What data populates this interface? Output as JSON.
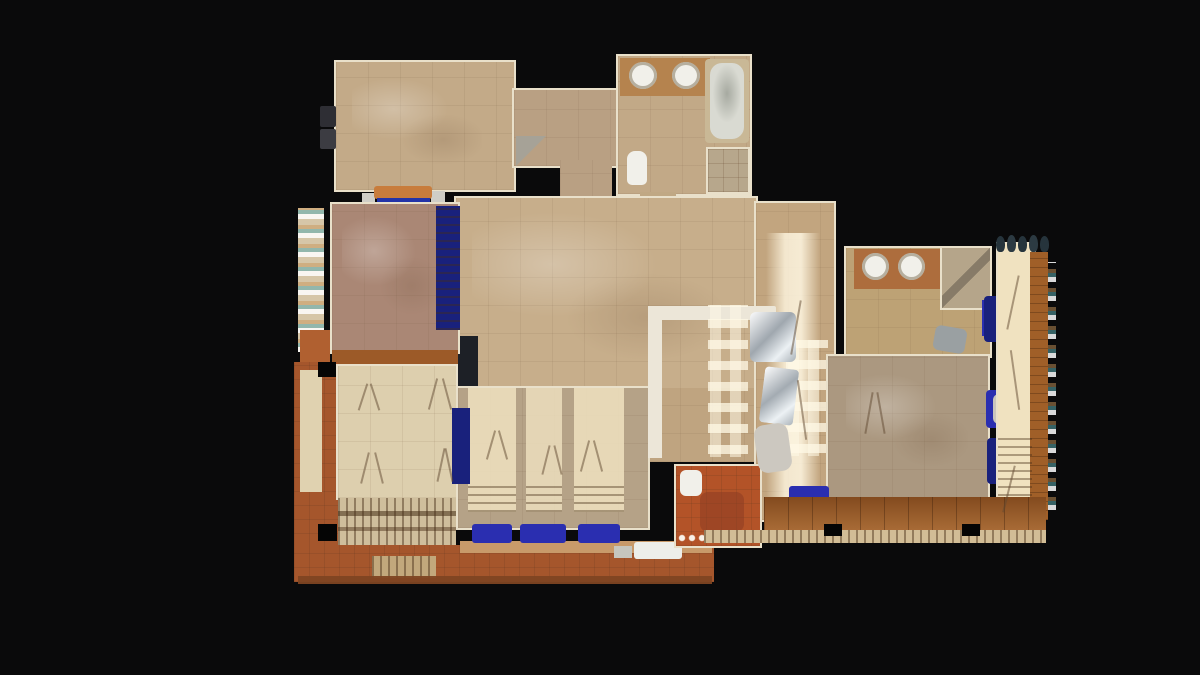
{
  "view": {
    "background": "#0a0a0b",
    "width": 1200,
    "height": 675
  },
  "palette": {
    "black": "#0a0a0b",
    "wall": "#e9e0ca",
    "tan1": "#c3aa88",
    "tan2": "#b9a083",
    "tan3": "#c7ae8b",
    "tan4": "#b5a287",
    "tan5": "#bda275",
    "tan6": "#ab9880",
    "cream": "#ddcfae",
    "cream2": "#f0e2c0",
    "mauve": "#aa8775",
    "terra": "#a5562c",
    "terra2": "#b35328",
    "rust": "#9c5a28",
    "wood": "#9a5824",
    "wood2": "#a05f28",
    "counter1": "#b5834e",
    "counter2": "#ad6d3d",
    "white": "#f1f0ea",
    "gray": "#9aa0a2",
    "navy": "#19217c",
    "blue": "#2a2eb0",
    "steel": "#c3c8cc",
    "sh": "rgba(95,72,48,0.5)"
  },
  "scene": {
    "items": [
      {
        "n": "master-bedroom-floor",
        "x": 336,
        "y": 62,
        "w": 178,
        "h": 128,
        "f": "tan1",
        "t": "tile",
        "wall": true
      },
      {
        "n": "master-bedroom-floor-sheen",
        "x": 352,
        "y": 78,
        "w": 130,
        "h": 88,
        "f": "none",
        "t": "mottle"
      },
      {
        "n": "wall-ac-unit-1",
        "x": 320,
        "y": 106,
        "w": 16,
        "h": 21,
        "f": "#2e2e34",
        "r": "2px"
      },
      {
        "n": "wall-ac-unit-2",
        "x": 320,
        "y": 129,
        "w": 16,
        "h": 20,
        "f": "#3c3c42",
        "r": "2px"
      },
      {
        "n": "bench-gray-left",
        "x": 362,
        "y": 193,
        "w": 13,
        "h": 15,
        "f": "#cfcdc6"
      },
      {
        "n": "bench-gray-right",
        "x": 431,
        "y": 191,
        "w": 14,
        "h": 17,
        "f": "#cfcdc6"
      },
      {
        "n": "daybed-orange",
        "x": 374,
        "y": 186,
        "w": 58,
        "h": 13,
        "f": "#c87c3c",
        "r": "3px"
      },
      {
        "n": "daybed-blue-cushion",
        "x": 377,
        "y": 198,
        "w": 53,
        "h": 10,
        "f": "#2333a8"
      },
      {
        "n": "vestibule-floor",
        "x": 514,
        "y": 90,
        "w": 103,
        "h": 76,
        "f": "tan2",
        "t": "tile",
        "wall": true
      },
      {
        "n": "vestibule-door-swing",
        "x": 516,
        "y": 136,
        "w": 30,
        "h": 30,
        "f": "none",
        "t": "tri"
      },
      {
        "n": "hallway-connector",
        "x": 560,
        "y": 160,
        "w": 52,
        "h": 42,
        "f": "tan2",
        "t": "tile"
      },
      {
        "n": "bathroom1-floor",
        "x": 618,
        "y": 56,
        "w": 132,
        "h": 138,
        "f": "#c2a987",
        "t": "tile",
        "wall": true
      },
      {
        "n": "bathroom1-vanity-counter",
        "x": 620,
        "y": 58,
        "w": 90,
        "h": 38,
        "f": "counter1"
      },
      {
        "n": "bathroom1-sink-left",
        "x": 629,
        "y": 62,
        "w": 28,
        "h": 27,
        "f": "white",
        "shape": "ellipse",
        "ring": true
      },
      {
        "n": "bathroom1-sink-right",
        "x": 672,
        "y": 62,
        "w": 28,
        "h": 27,
        "f": "white",
        "shape": "ellipse",
        "ring": true
      },
      {
        "n": "bathtub-surround",
        "x": 705,
        "y": 59,
        "w": 44,
        "h": 84,
        "f": "#c9b896",
        "r": "4px"
      },
      {
        "n": "bathtub-basin",
        "x": 710,
        "y": 63,
        "w": 34,
        "h": 76,
        "f": "#d9dad2",
        "t": "tub",
        "r": "12px"
      },
      {
        "n": "shower1-enclosure",
        "x": 708,
        "y": 149,
        "w": 40,
        "h": 43,
        "f": "#b7a78c",
        "t": "tile-small",
        "wall": true
      },
      {
        "n": "toilet1",
        "x": 627,
        "y": 151,
        "w": 20,
        "h": 34,
        "f": "white",
        "r": "8px 8px 5px 5px"
      },
      {
        "n": "bathroom1-door-connector",
        "x": 640,
        "y": 192,
        "w": 36,
        "h": 10,
        "f": "#c0a884"
      },
      {
        "n": "living-room-floor",
        "x": 456,
        "y": 198,
        "w": 300,
        "h": 192,
        "f": "tan3",
        "t": "tile",
        "wall": true
      },
      {
        "n": "living-room-floor-sheen",
        "x": 472,
        "y": 212,
        "w": 250,
        "h": 150,
        "f": "none",
        "t": "mottle"
      },
      {
        "n": "kitchen-corridor-floor",
        "x": 648,
        "y": 388,
        "w": 108,
        "h": 74,
        "f": "#bfa480",
        "t": "tile"
      },
      {
        "n": "dining-corridor-floor",
        "x": 756,
        "y": 203,
        "w": 78,
        "h": 317,
        "f": "#c2a57f",
        "t": "tile",
        "wall": true
      },
      {
        "n": "sunlight-streak",
        "x": 766,
        "y": 233,
        "w": 54,
        "h": 278,
        "f": "none",
        "t": "streak"
      },
      {
        "n": "lower-living-floor",
        "x": 458,
        "y": 388,
        "w": 190,
        "h": 140,
        "f": "tan4",
        "t": "tile",
        "wall": true
      },
      {
        "n": "sunlight-band-1",
        "x": 468,
        "y": 388,
        "w": 48,
        "h": 124,
        "f": "cream2",
        "op": 0.85
      },
      {
        "n": "sunlight-band-2",
        "x": 526,
        "y": 388,
        "w": 36,
        "h": 124,
        "f": "cream2",
        "op": 0.8
      },
      {
        "n": "sunlight-band-3",
        "x": 574,
        "y": 388,
        "w": 50,
        "h": 124,
        "f": "cream2",
        "op": 0.85
      },
      {
        "n": "shutter-shadow-1",
        "x": 468,
        "y": 486,
        "w": 48,
        "h": 26,
        "f": "none",
        "t": "slats-h"
      },
      {
        "n": "shutter-shadow-2",
        "x": 526,
        "y": 486,
        "w": 36,
        "h": 26,
        "f": "none",
        "t": "slats-h"
      },
      {
        "n": "shutter-shadow-3",
        "x": 574,
        "y": 486,
        "w": 50,
        "h": 26,
        "f": "none",
        "t": "slats-h"
      },
      {
        "n": "kitchen-counter-top",
        "x": 648,
        "y": 306,
        "w": 128,
        "h": 14,
        "f": "#ece6d8",
        "r": "2px"
      },
      {
        "n": "kitchen-counter-side",
        "x": 648,
        "y": 306,
        "w": 14,
        "h": 152,
        "f": "#ece6d8"
      },
      {
        "n": "window-lattice-light-1",
        "x": 708,
        "y": 305,
        "w": 40,
        "h": 152,
        "f": "none",
        "t": "lattice"
      },
      {
        "n": "window-lattice-light-2",
        "x": 786,
        "y": 340,
        "w": 42,
        "h": 116,
        "f": "none",
        "t": "lattice"
      },
      {
        "n": "steel-appliance-1",
        "x": 750,
        "y": 312,
        "w": 46,
        "h": 50,
        "f": "steel",
        "t": "shine",
        "r": "6px"
      },
      {
        "n": "steel-appliance-2",
        "x": 762,
        "y": 368,
        "w": 34,
        "h": 56,
        "f": "#ccd1d4",
        "t": "shine",
        "r": "4px",
        "rot": 7
      },
      {
        "n": "fireplace-dark-object",
        "x": 452,
        "y": 336,
        "w": 26,
        "h": 50,
        "f": "#1d2026"
      },
      {
        "n": "pink-bedroom-floor",
        "x": 332,
        "y": 204,
        "w": 126,
        "h": 148,
        "f": "mauve",
        "t": "tile",
        "wall": true
      },
      {
        "n": "pink-bedroom-sheen",
        "x": 342,
        "y": 216,
        "w": 100,
        "h": 100,
        "f": "none",
        "t": "mottle"
      },
      {
        "n": "blue-drapery",
        "x": 436,
        "y": 206,
        "w": 24,
        "h": 124,
        "f": "navy",
        "t": "slats-h"
      },
      {
        "n": "balcony-left-railing",
        "x": 298,
        "y": 208,
        "w": 26,
        "h": 144,
        "f": "#d6c6a8",
        "t": "speckle"
      },
      {
        "n": "balcony-left-terracotta",
        "x": 300,
        "y": 330,
        "w": 30,
        "h": 44,
        "f": "#b06030"
      },
      {
        "n": "blue-chest",
        "x": 433,
        "y": 352,
        "w": 22,
        "h": 26,
        "f": "navy"
      },
      {
        "n": "rust-transition-band",
        "x": 332,
        "y": 350,
        "w": 126,
        "h": 14,
        "f": "rust"
      },
      {
        "n": "terrace-walkway-left",
        "x": 294,
        "y": 362,
        "w": 44,
        "h": 214,
        "f": "terra",
        "t": "tile-small"
      },
      {
        "n": "terrace-walkway-inner-cream",
        "x": 300,
        "y": 370,
        "w": 22,
        "h": 122,
        "f": "#e0d2b0"
      },
      {
        "n": "garden-room-floor",
        "x": 338,
        "y": 366,
        "w": 118,
        "h": 132,
        "f": "cream",
        "t": "tile",
        "wall": true
      },
      {
        "n": "pergola-slatted-deck",
        "x": 338,
        "y": 498,
        "w": 118,
        "h": 62,
        "f": "#cfbe9c",
        "t": "slats-v"
      },
      {
        "n": "pergola-beam-1",
        "x": 338,
        "y": 511,
        "w": 118,
        "h": 5,
        "f": "rgba(70,45,22,0.55)"
      },
      {
        "n": "pergola-beam-2",
        "x": 338,
        "y": 527,
        "w": 118,
        "h": 4,
        "f": "rgba(70,45,22,0.45)"
      },
      {
        "n": "corner-post-1",
        "x": 318,
        "y": 362,
        "w": 18,
        "h": 15,
        "f": "#050505"
      },
      {
        "n": "corner-post-2",
        "x": 318,
        "y": 524,
        "w": 19,
        "h": 17,
        "f": "#050505"
      },
      {
        "n": "blue-daybed",
        "x": 452,
        "y": 408,
        "w": 18,
        "h": 76,
        "f": "navy"
      },
      {
        "n": "terrace-floor",
        "x": 294,
        "y": 545,
        "w": 420,
        "h": 37,
        "f": "terra",
        "t": "tile-small"
      },
      {
        "n": "terrace-tan-band",
        "x": 460,
        "y": 541,
        "w": 252,
        "h": 12,
        "f": "#c89a6a"
      },
      {
        "n": "terrace-steps",
        "x": 372,
        "y": 556,
        "w": 64,
        "h": 22,
        "f": "#c2a87c",
        "t": "slats-v"
      },
      {
        "n": "sofa-lounger-1",
        "x": 472,
        "y": 524,
        "w": 40,
        "h": 19,
        "f": "blue",
        "r": "3px"
      },
      {
        "n": "sofa-lounger-2",
        "x": 520,
        "y": 524,
        "w": 46,
        "h": 19,
        "f": "blue",
        "r": "3px"
      },
      {
        "n": "sofa-lounger-3",
        "x": 578,
        "y": 524,
        "w": 42,
        "h": 19,
        "f": "blue",
        "r": "3px"
      },
      {
        "n": "terrace-table-white",
        "x": 634,
        "y": 542,
        "w": 48,
        "h": 17,
        "f": "#edeeea",
        "r": "3px"
      },
      {
        "n": "terrace-object-gray",
        "x": 614,
        "y": 546,
        "w": 18,
        "h": 12,
        "f": "#c6c6be"
      },
      {
        "n": "terrace-edge",
        "x": 298,
        "y": 576,
        "w": 414,
        "h": 8,
        "f": "#7e4522",
        "op": 0.95
      },
      {
        "n": "patio-room-floor",
        "x": 676,
        "y": 466,
        "w": 84,
        "h": 80,
        "f": "terra2",
        "t": "tile-small",
        "wall": true
      },
      {
        "n": "patio-red-patch",
        "x": 700,
        "y": 492,
        "w": 44,
        "h": 40,
        "f": "rgba(140,60,35,0.55)",
        "r": "8px"
      },
      {
        "n": "patio-toilet",
        "x": 680,
        "y": 470,
        "w": 22,
        "h": 26,
        "f": "white",
        "r": "6px"
      },
      {
        "n": "pebble-border",
        "x": 678,
        "y": 534,
        "w": 80,
        "h": 9,
        "f": "none",
        "t": "dots"
      },
      {
        "n": "patio-chair-gray",
        "x": 756,
        "y": 424,
        "w": 34,
        "h": 48,
        "f": "#ccc8c0",
        "r": "10px",
        "rot": -8
      },
      {
        "n": "bathroom2-floor",
        "x": 846,
        "y": 248,
        "w": 144,
        "h": 108,
        "f": "tan5",
        "t": "tile",
        "wall": true
      },
      {
        "n": "bathroom2-vanity-counter",
        "x": 854,
        "y": 249,
        "w": 86,
        "h": 40,
        "f": "counter2"
      },
      {
        "n": "bathroom2-sink-left",
        "x": 862,
        "y": 253,
        "w": 27,
        "h": 27,
        "f": "white",
        "shape": "ellipse",
        "ring": true
      },
      {
        "n": "bathroom2-sink-right",
        "x": 898,
        "y": 253,
        "w": 27,
        "h": 27,
        "f": "white",
        "shape": "ellipse",
        "ring": true
      },
      {
        "n": "shower2-enclosure",
        "x": 942,
        "y": 248,
        "w": 48,
        "h": 60,
        "f": "#b5a58a",
        "t": "diag",
        "wall": true
      },
      {
        "n": "towel-blue",
        "x": 982,
        "y": 300,
        "w": 13,
        "h": 36,
        "f": "blue"
      },
      {
        "n": "bathroom2-stool",
        "x": 934,
        "y": 327,
        "w": 32,
        "h": 25,
        "f": "gray",
        "r": "6px",
        "rot": 10
      },
      {
        "n": "bedroom2-floor",
        "x": 828,
        "y": 356,
        "w": 160,
        "h": 142,
        "f": "tan6",
        "t": "tile",
        "wall": true
      },
      {
        "n": "bedroom2-sheen",
        "x": 846,
        "y": 374,
        "w": 122,
        "h": 94,
        "f": "none",
        "t": "mottle"
      },
      {
        "n": "bedroom2-sofa-blue",
        "x": 789,
        "y": 486,
        "w": 40,
        "h": 18,
        "f": "blue",
        "r": "3px"
      },
      {
        "n": "planter-blue-1",
        "x": 984,
        "y": 296,
        "w": 22,
        "h": 46,
        "f": "navy",
        "r": "4px"
      },
      {
        "n": "planter-blue-2",
        "x": 986,
        "y": 390,
        "w": 20,
        "h": 38,
        "f": "blue",
        "r": "4px"
      },
      {
        "n": "planter-blue-3",
        "x": 987,
        "y": 438,
        "w": 22,
        "h": 46,
        "f": "navy",
        "r": "4px"
      },
      {
        "n": "white-pedestal",
        "x": 993,
        "y": 394,
        "w": 13,
        "h": 30,
        "f": "#c9c5bc",
        "r": "6px"
      },
      {
        "n": "balcony-floor",
        "x": 998,
        "y": 244,
        "w": 36,
        "h": 276,
        "f": "cream2",
        "wall": true
      },
      {
        "n": "balcony-wood-band",
        "x": 1030,
        "y": 252,
        "w": 18,
        "h": 268,
        "f": "wood2",
        "t": "wood-h"
      },
      {
        "n": "balcony-plank-shadows",
        "x": 998,
        "y": 438,
        "w": 34,
        "h": 82,
        "f": "none",
        "t": "slats-h"
      },
      {
        "n": "balcony-railing-right",
        "x": 1048,
        "y": 262,
        "w": 8,
        "h": 248,
        "f": "none",
        "t": "speckle"
      },
      {
        "n": "railing-plant-1",
        "x": 996,
        "y": 236,
        "w": 9,
        "h": 16,
        "f": "#26343c",
        "r": "50% 50% 40% 40%"
      },
      {
        "n": "railing-plant-2",
        "x": 1007,
        "y": 235,
        "w": 9,
        "h": 17,
        "f": "#2c3a42",
        "r": "50% 50% 40% 40%"
      },
      {
        "n": "railing-plant-3",
        "x": 1018,
        "y": 236,
        "w": 9,
        "h": 16,
        "f": "#26343c",
        "r": "50% 50% 40% 40%"
      },
      {
        "n": "railing-plant-4",
        "x": 1029,
        "y": 235,
        "w": 9,
        "h": 17,
        "f": "#2c3a42",
        "r": "50% 50% 40% 40%"
      },
      {
        "n": "railing-plant-5",
        "x": 1040,
        "y": 236,
        "w": 9,
        "h": 16,
        "f": "#26343c",
        "r": "50% 50% 40% 40%"
      },
      {
        "n": "deck-floor",
        "x": 764,
        "y": 497,
        "w": 282,
        "h": 34,
        "f": "wood",
        "t": "planks"
      },
      {
        "n": "deck-pergola-slats",
        "x": 704,
        "y": 530,
        "w": 342,
        "h": 13,
        "f": "#d2bd96",
        "t": "slats-v"
      },
      {
        "n": "deck-post-1",
        "x": 824,
        "y": 524,
        "w": 18,
        "h": 12,
        "f": "#050505"
      },
      {
        "n": "deck-post-2",
        "x": 962,
        "y": 524,
        "w": 18,
        "h": 12,
        "f": "#050505"
      },
      {
        "n": "tripod-shadow",
        "x": 362,
        "y": 383,
        "w": 2,
        "h": 28,
        "f": "sh",
        "rot": 18
      },
      {
        "n": "tripod-shadow",
        "x": 374,
        "y": 383,
        "w": 2,
        "h": 28,
        "f": "sh",
        "rot": -18
      },
      {
        "n": "tripod-shadow",
        "x": 432,
        "y": 378,
        "w": 2,
        "h": 32,
        "f": "sh",
        "rot": 15
      },
      {
        "n": "tripod-shadow",
        "x": 446,
        "y": 378,
        "w": 2,
        "h": 32,
        "f": "sh",
        "rot": -15
      },
      {
        "n": "tripod-shadow",
        "x": 364,
        "y": 452,
        "w": 2,
        "h": 32,
        "f": "sh",
        "rot": 14
      },
      {
        "n": "tripod-shadow",
        "x": 378,
        "y": 452,
        "w": 2,
        "h": 32,
        "f": "sh",
        "rot": -14
      },
      {
        "n": "tripod-shadow",
        "x": 440,
        "y": 448,
        "w": 2,
        "h": 34,
        "f": "sh",
        "rot": 12
      },
      {
        "n": "tripod-shadow",
        "x": 448,
        "y": 448,
        "w": 2,
        "h": 34,
        "f": "sh",
        "rot": -12
      },
      {
        "n": "tripod-shadow",
        "x": 490,
        "y": 430,
        "w": 2,
        "h": 30,
        "f": "sh",
        "rot": 16
      },
      {
        "n": "tripod-shadow",
        "x": 502,
        "y": 430,
        "w": 2,
        "h": 30,
        "f": "sh",
        "rot": -16
      },
      {
        "n": "tripod-shadow",
        "x": 545,
        "y": 445,
        "w": 2,
        "h": 30,
        "f": "sh",
        "rot": 14
      },
      {
        "n": "tripod-shadow",
        "x": 557,
        "y": 445,
        "w": 2,
        "h": 30,
        "f": "sh",
        "rot": -14
      },
      {
        "n": "tripod-shadow",
        "x": 584,
        "y": 440,
        "w": 2,
        "h": 32,
        "f": "sh",
        "rot": 15
      },
      {
        "n": "tripod-shadow",
        "x": 597,
        "y": 440,
        "w": 2,
        "h": 32,
        "f": "sh",
        "rot": -15
      },
      {
        "n": "tripod-shadow",
        "x": 795,
        "y": 300,
        "w": 2,
        "h": 55,
        "f": "sh",
        "rot": 10
      },
      {
        "n": "tripod-shadow",
        "x": 801,
        "y": 380,
        "w": 2,
        "h": 60,
        "f": "sh",
        "rot": -8
      },
      {
        "n": "tripod-shadow",
        "x": 868,
        "y": 392,
        "w": 2,
        "h": 42,
        "f": "sh",
        "rot": 10
      },
      {
        "n": "tripod-shadow",
        "x": 880,
        "y": 392,
        "w": 2,
        "h": 42,
        "f": "sh",
        "rot": -10
      },
      {
        "n": "tripod-shadow",
        "x": 1012,
        "y": 275,
        "w": 2,
        "h": 55,
        "f": "sh",
        "rot": 12
      },
      {
        "n": "tripod-shadow",
        "x": 1014,
        "y": 350,
        "w": 2,
        "h": 60,
        "f": "sh",
        "rot": -8
      },
      {
        "n": "tripod-shadow",
        "x": 1008,
        "y": 465,
        "w": 2,
        "h": 48,
        "f": "sh",
        "rot": 14
      }
    ]
  }
}
